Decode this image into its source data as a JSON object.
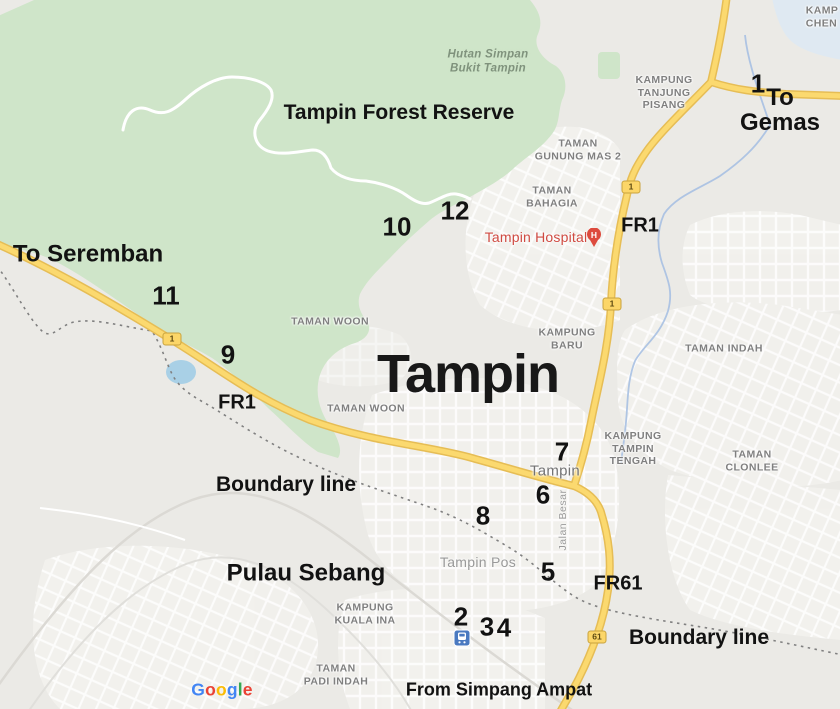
{
  "annotations": {
    "forest_reserve": "Tampin Forest Reserve",
    "to_gemas": "To Gemas",
    "to_seremban": "To Seremban",
    "fr1_north": "FR1",
    "fr1_west": "FR1",
    "fr61": "FR61",
    "boundary_west": "Boundary line",
    "boundary_south": "Boundary line",
    "pulau_sebang": "Pulau Sebang",
    "from_simpang_ampat": "From Simpang Ampat",
    "city_big": "Tampin"
  },
  "numbered_markers": [
    "1",
    "2",
    "3",
    "4",
    "5",
    "6",
    "7",
    "8",
    "9",
    "10",
    "11",
    "12"
  ],
  "route_shields": {
    "route1": "1",
    "route61": "61"
  },
  "place_labels": {
    "hutan_simpan": "Hutan Simpan\nBukit Tampin",
    "kampung_tanjung_pisang": "KAMPUNG\nTANJUNG\nPISANG",
    "kampung_chen": "KAMP\nCHEN",
    "taman_gunung_mas": "TAMAN\nGUNUNG MAS 2",
    "taman_bahagia": "TAMAN\nBAHAGIA",
    "taman_woon_north": "TAMAN WOON",
    "taman_woon_south": "TAMAN WOON",
    "kampung_baru": "KAMPUNG\nBARU",
    "taman_indah": "TAMAN INDAH",
    "kampung_tampin_tengah": "KAMPUNG\nTAMPIN\nTENGAH",
    "taman_clonlee": "TAMAN CLONLEE",
    "tampin_town": "Tampin",
    "jalan_besar": "Jalan Besar",
    "tampin_pos": "Tampin Pos",
    "kampung_kuala_ina": "KAMPUNG\nKUALA INA",
    "taman_padi_indah": "TAMAN\nPADI INDAH"
  },
  "poi": {
    "hospital_label": "Tampin Hospital",
    "hospital_icon_letter": "H"
  },
  "attribution": {
    "brand": "Google",
    "letters": [
      {
        "ch": "G",
        "color": "#4285F4"
      },
      {
        "ch": "o",
        "color": "#EA4335"
      },
      {
        "ch": "o",
        "color": "#FBBC05"
      },
      {
        "ch": "g",
        "color": "#4285F4"
      },
      {
        "ch": "l",
        "color": "#34A853"
      },
      {
        "ch": "e",
        "color": "#EA4335"
      }
    ]
  },
  "colors": {
    "background": "#ebeae6",
    "forest_green": "#cfe5c9",
    "road_yellow": "#fbd96f",
    "road_casing": "#e6bd55",
    "water_blue": "#a9d0e6",
    "stream_blue": "#a7c0e2",
    "urban_fill": "#f3f2ee",
    "boundary_dash_gray": "#808080",
    "hospital_red": "#dd4b3e",
    "transit_blue": "#4a79c0",
    "marker_black": "#121212",
    "label_gray": "#7f7f7f"
  }
}
